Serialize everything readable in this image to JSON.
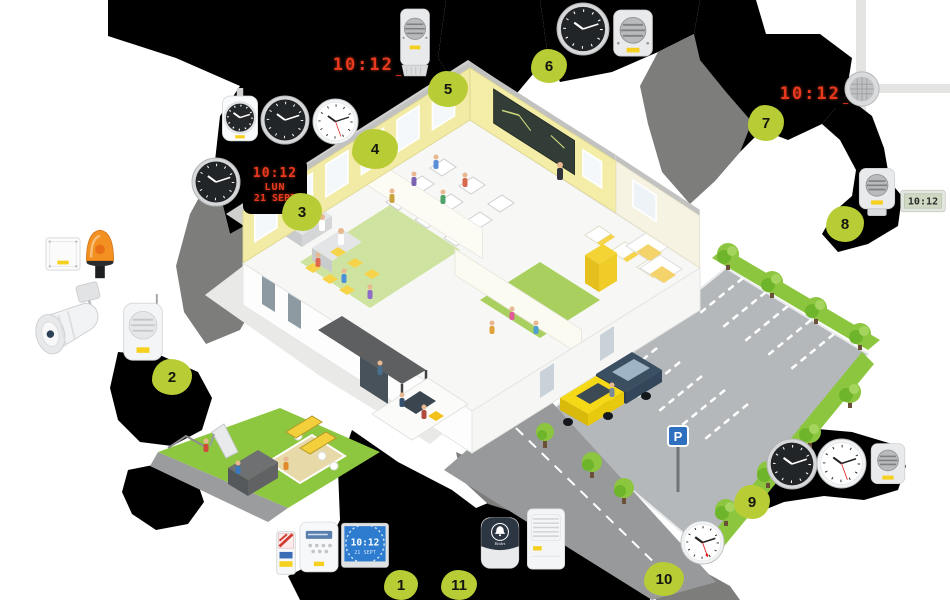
{
  "brand": "Bodet",
  "displays": {
    "led_time": "10:12",
    "led_suffix": "_",
    "led_date_line1": "10:12",
    "led_date_line2": "LUN",
    "led_date_line3": "21 SEPT",
    "lcd_time": "10:12",
    "blue_lcd_time": "10:12",
    "blue_lcd_date": "21 SEPT",
    "analog_time": "10:12"
  },
  "parking": {
    "sign": "P"
  },
  "markers": [
    {
      "label": "1"
    },
    {
      "label": "2"
    },
    {
      "label": "3"
    },
    {
      "label": "4"
    },
    {
      "label": "5"
    },
    {
      "label": "6"
    },
    {
      "label": "7"
    },
    {
      "label": "8"
    },
    {
      "label": "9"
    },
    {
      "label": "10"
    },
    {
      "label": "11"
    }
  ],
  "products": [
    {
      "id": "double-sided-clock"
    },
    {
      "id": "analog-clock-black"
    },
    {
      "id": "analog-clock-white"
    },
    {
      "id": "led-digital-clock"
    },
    {
      "id": "led-calendar-clock"
    },
    {
      "id": "wall-speaker"
    },
    {
      "id": "ceiling-speaker"
    },
    {
      "id": "lcd-digital-clock"
    },
    {
      "id": "lcd-calendar-clock-blue"
    },
    {
      "id": "master-clock-control"
    },
    {
      "id": "radio-transmitter"
    },
    {
      "id": "bell-sounder"
    },
    {
      "id": "siren-box"
    },
    {
      "id": "horn-loudspeaker"
    },
    {
      "id": "flashing-beacon"
    },
    {
      "id": "junction-box"
    }
  ],
  "colors": {
    "accent_green": "#b8cc35",
    "led_red": "#e8391f",
    "grass_green": "#8dc63f",
    "building_yellow": "#f2eba6",
    "car_yellow": "#f5d916",
    "car_blue": "#3b4f63",
    "lcd_blue": "#2e7cd0",
    "shadow_black": "#000000",
    "shadow_gray": "#7d7d7c"
  }
}
